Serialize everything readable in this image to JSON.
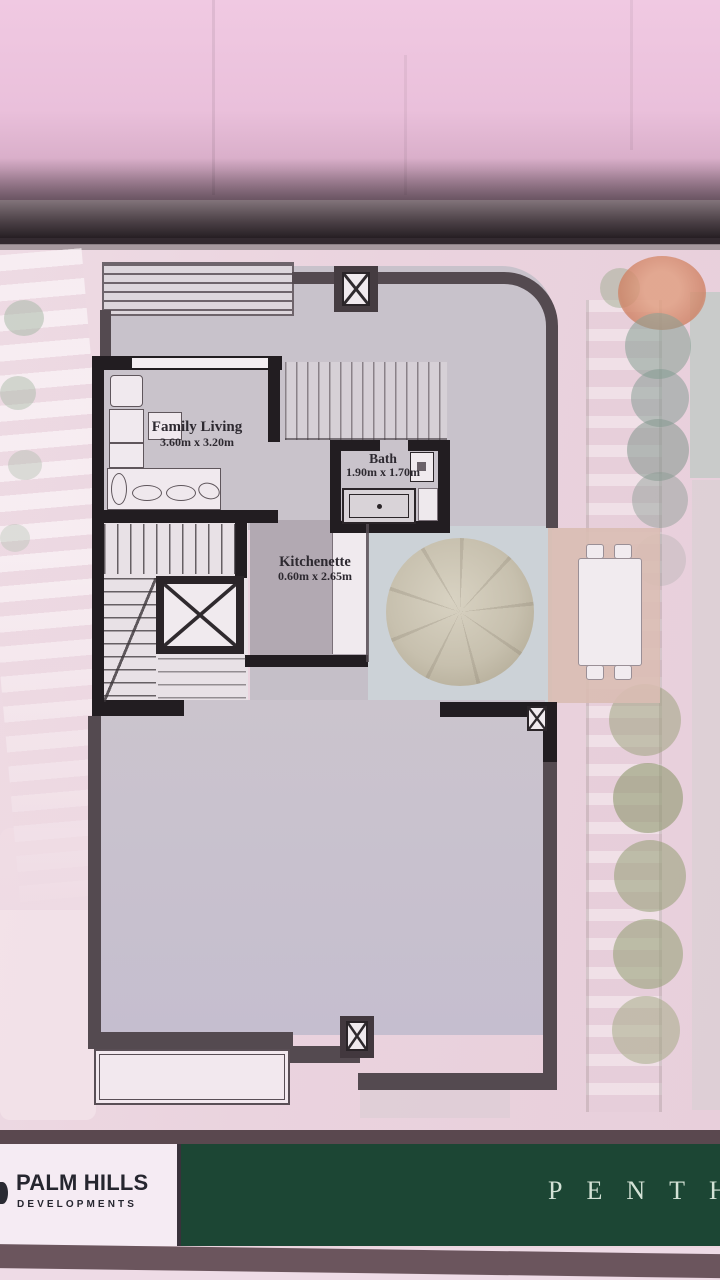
{
  "plan": {
    "rooms": [
      {
        "name": "Family Living",
        "dims": "3.60m x 3.20m"
      },
      {
        "name": "Bath",
        "dims": "1.90m x 1.70m"
      },
      {
        "name": "Kitchenette",
        "dims": "0.60m x 2.65m"
      }
    ]
  },
  "footer": {
    "brand_name": "PALM HILLS",
    "brand_tagline": "DEVELOPMENTS",
    "plan_label": "PENTH",
    "colors": {
      "banner_green": "#1c4634",
      "logo_text": "#26262f",
      "label_text": "#d3e1d5"
    }
  },
  "colors": {
    "background_pink": "#ecd7e0",
    "page_shadow": "#241d22",
    "plan_floor": "#c8c2cb",
    "terrace_wall": "#544a50",
    "interior_wall": "#221d21",
    "patio_floor": "#ccd2d7",
    "deck_floor": "#d9bdb3",
    "footer_strip": "#6b555d"
  }
}
